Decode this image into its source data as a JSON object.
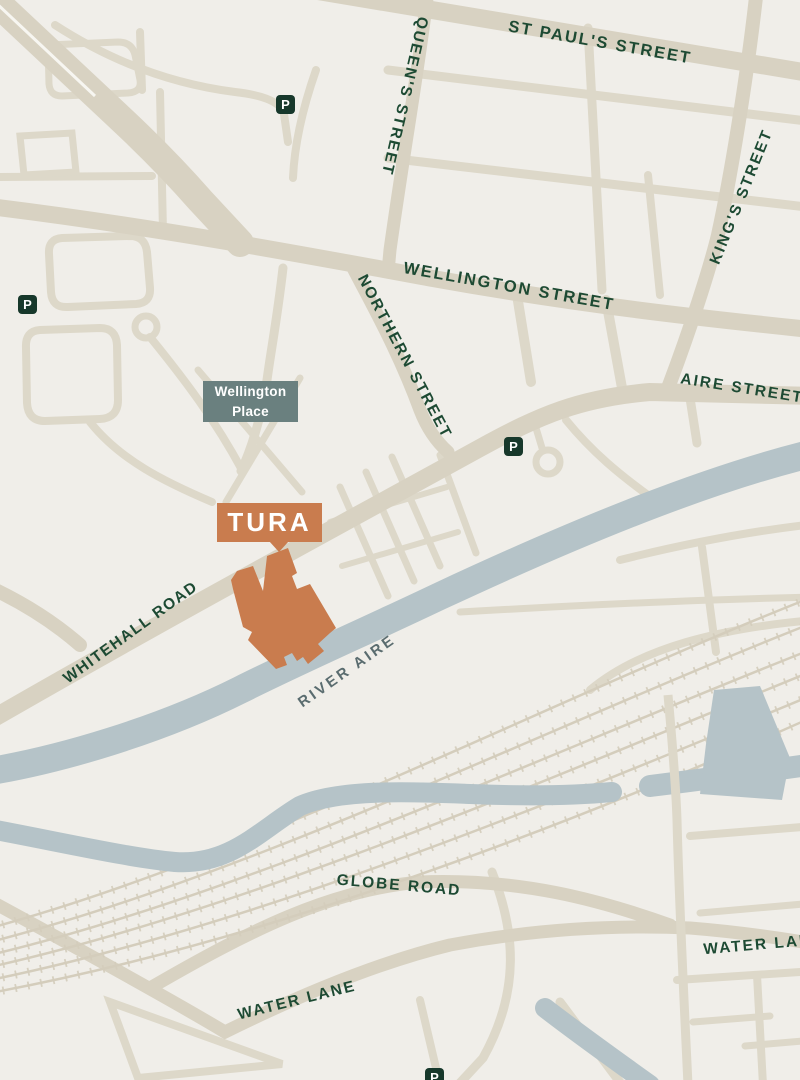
{
  "map": {
    "tura_marker": {
      "label": "TURA"
    },
    "area_marker": {
      "label": "Wellington Place"
    },
    "parking_label": "P",
    "river_label": "RIVER AIRE",
    "streets": {
      "st_pauls": "ST PAUL'S STREET",
      "queens": "QUEEN'S STREET",
      "kings": "KING'S STREET",
      "wellington": "WELLINGTON STREET",
      "northern": "NORTHERN STREET",
      "aire": "AIRE STREET",
      "whitehall": "WHITEHALL ROAD",
      "globe": "GLOBE ROAD",
      "water_lane_west": "WATER LANE",
      "water_lane_east": "WATER LANE"
    },
    "colors": {
      "background": "#f0eee9",
      "road_major": "#d8d2c2",
      "road_minor": "#ddd8c9",
      "railway": "#d4cdbc",
      "water": "#b5c3c8",
      "street_text": "#1d4a33",
      "river_text": "#5a6c6f",
      "accent_orange": "#c97c4e",
      "area_box": "#6a807f",
      "parking_badge": "#17382b"
    }
  }
}
